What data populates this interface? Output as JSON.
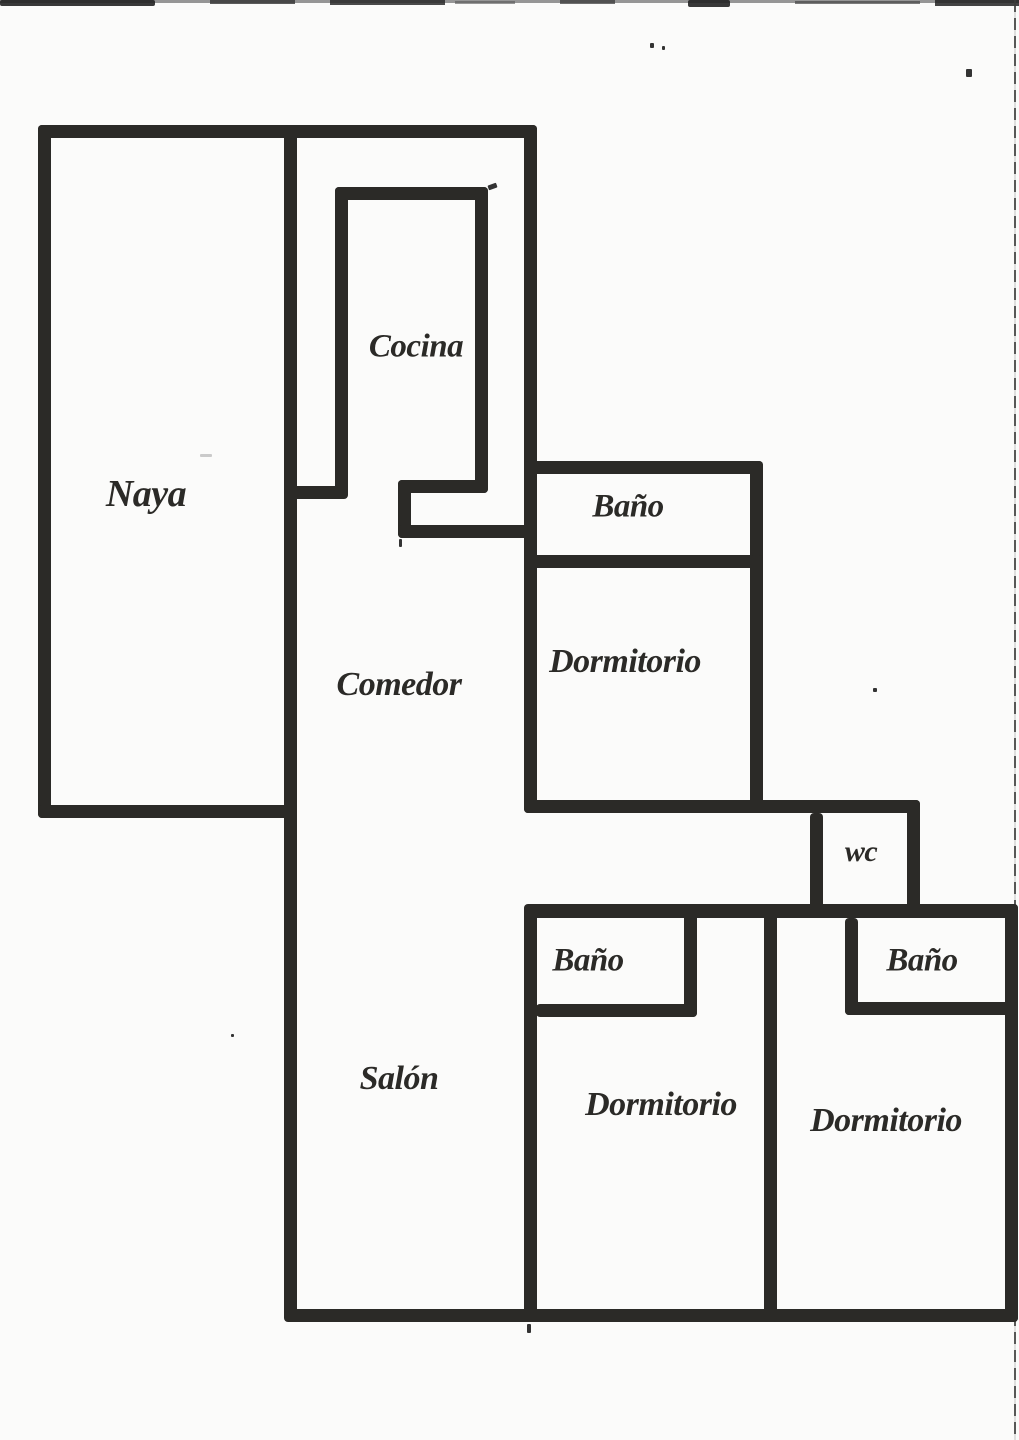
{
  "palette": {
    "ink": "#2b2a27",
    "paper": "#fbfbfa"
  },
  "plan": {
    "rooms": {
      "naya": {
        "label": "Naya"
      },
      "cocina": {
        "label": "Cocina"
      },
      "bano_top": {
        "label": "Baño"
      },
      "dormitorio_top": {
        "label": "Dormitorio"
      },
      "comedor": {
        "label": "Comedor"
      },
      "wc": {
        "label": "wc"
      },
      "bano_mid": {
        "label": "Baño"
      },
      "bano_right": {
        "label": "Baño"
      },
      "salon": {
        "label": "Salón"
      },
      "dormitorio_mid": {
        "label": "Dormitorio"
      },
      "dormitorio_right": {
        "label": "Dormitorio"
      }
    }
  }
}
